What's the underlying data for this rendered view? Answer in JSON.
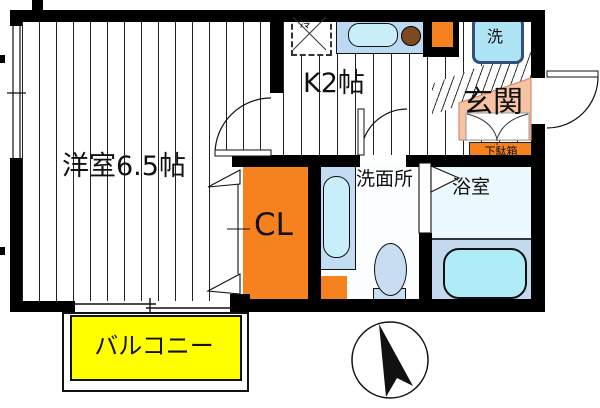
{
  "plan": {
    "type": "floor-plan",
    "rooms": {
      "western_room": {
        "label": "洋室6.5帖"
      },
      "kitchen": {
        "label": "K2帖"
      },
      "entrance": {
        "label": "玄関"
      },
      "shoe_cabinet": {
        "label": "下駄箱"
      },
      "closet": {
        "label": "CL"
      },
      "washroom": {
        "label": "洗面所"
      },
      "bathroom": {
        "label": "浴室"
      },
      "balcony": {
        "label": "バルコニー"
      }
    },
    "appliances": {
      "washing_machine": {
        "label": "洗"
      },
      "refrigerator": {
        "label": "冷"
      }
    },
    "colors": {
      "wall": "#000000",
      "closet_orange": "#F5821F",
      "balcony_yellow": "#FFFF00",
      "entrance_pink": "#F6C3A4",
      "counter_blue": "#BCD8F2",
      "sink_blue": "#C8EEFA",
      "burner_brown": "#7B4A21",
      "washer_blue": "#AEE4F4",
      "vanity_blue": "#C2DCF4",
      "fixture_blue": "#C8DCF2",
      "tub_cyan": "#AFECF8",
      "bath_floor": "#EBF8FE",
      "tub_area_blue": "#C3D9EE",
      "washroom_floor": "#FBFDFF"
    }
  }
}
